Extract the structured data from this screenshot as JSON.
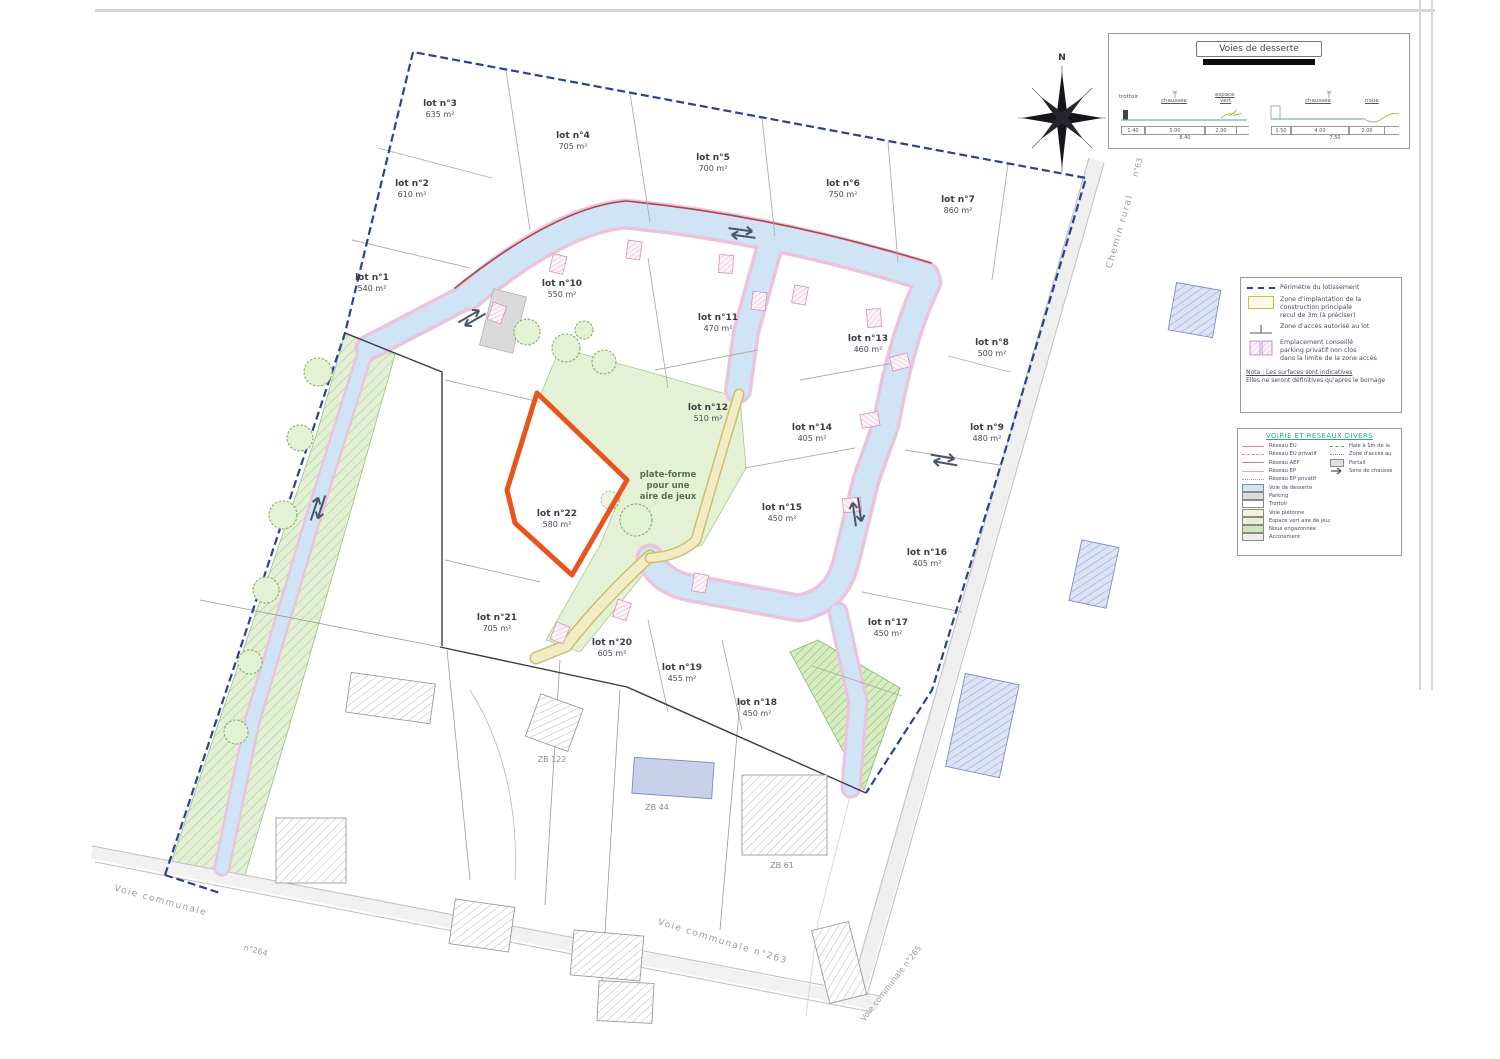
{
  "colors": {
    "highlight_orange": "#e8541d",
    "perimeter_blue": "#2a3f9e",
    "road_blue": "#cfe4f4",
    "legend_title_green": "#2aa87c"
  },
  "panel_voies": {
    "title": "Voies de desserte",
    "left_label_1": "trottoir",
    "left_label_2": "chaussée",
    "left_label_3a": "espace",
    "left_label_3b": "vert",
    "left_dim_1": "1.40",
    "left_dim_2": "5.00",
    "left_dim_3": "2.00",
    "left_total": "8.40",
    "right_label_1": "chaussée",
    "right_label_2": "noue",
    "right_dim_1": "1.50",
    "right_dim_2": "4.00",
    "right_dim_3": "2.00",
    "right_total": "7.50"
  },
  "legend_zones": {
    "item1": "Périmètre du lotissement",
    "item2a": "Zone d'implantation de la",
    "item2b": "construction principale",
    "item2c": "recul de 3m (à préciser)",
    "item3": "Zone d'accès autorisé au lot",
    "item4a": "Emplacement conseillé",
    "item4b": "parking privatif non clos",
    "item4c": "dans la limite de la zone accès",
    "note_title": "Nota : Les surfaces sont indicatives",
    "note_body": "Elles ne seront définitives qu'après le bornage"
  },
  "legend_vrd": {
    "title": "VOIRIE ET RESEAUX DIVERS",
    "line_1": "Réseau EU",
    "line_2": "Réseau EU privatif",
    "line_3": "Réseau AEP",
    "line_4": "Réseau EP",
    "line_5": "Réseau EP privatif",
    "surf_1": "Voie de desserte",
    "surf_2": "Parking",
    "surf_3": "Trottoir",
    "surf_4": "Voie piétonne",
    "surf_5": "Espace vert aire de jeux",
    "surf_6": "Noue engazonnée",
    "surf_7": "Accotement",
    "right_1": "Haie à 1m de la voie",
    "right_2": "Zone d'accès au lot",
    "right_3": "Portail",
    "right_4": "Sens de chaussée"
  },
  "lots": [
    {
      "name": "lot n°1",
      "area": "540 m²"
    },
    {
      "name": "lot n°2",
      "area": "610 m²"
    },
    {
      "name": "lot n°3",
      "area": "635 m²"
    },
    {
      "name": "lot n°4",
      "area": "705 m²"
    },
    {
      "name": "lot n°5",
      "area": "700 m²"
    },
    {
      "name": "lot n°6",
      "area": "750 m²"
    },
    {
      "name": "lot n°7",
      "area": "860 m²"
    },
    {
      "name": "lot n°8",
      "area": "500 m²"
    },
    {
      "name": "lot n°9",
      "area": "480 m²"
    },
    {
      "name": "lot n°10",
      "area": "550 m²"
    },
    {
      "name": "lot n°11",
      "area": "470 m²"
    },
    {
      "name": "lot n°12",
      "area": "510 m²"
    },
    {
      "name": "lot n°13",
      "area": "460 m²"
    },
    {
      "name": "lot n°14",
      "area": "405 m²"
    },
    {
      "name": "lot n°15",
      "area": "450 m²"
    },
    {
      "name": "lot n°16",
      "area": "405 m²"
    },
    {
      "name": "lot n°17",
      "area": "450 m²"
    },
    {
      "name": "lot n°18",
      "area": "450 m²"
    },
    {
      "name": "lot n°19",
      "area": "455 m²"
    },
    {
      "name": "lot n°20",
      "area": "605 m²"
    },
    {
      "name": "lot n°21",
      "area": "705 m²"
    },
    {
      "name": "lot n°22",
      "area": "580 m²"
    }
  ],
  "plan_labels": {
    "playground_1": "plate-forme",
    "playground_2": "pour une",
    "playground_3": "aire de jeux",
    "parcel_1": "ZB 122",
    "parcel_2": "ZB 44",
    "parcel_3": "ZB 61",
    "north": "N",
    "road_chemin": "Chemin rural",
    "road_chemin_no": "n°63",
    "road_vc": "Voie communale",
    "road_vc_no": "n°264",
    "road_vc263": "Voie communale n°263",
    "road_vc265": "Voie communale n°265"
  }
}
